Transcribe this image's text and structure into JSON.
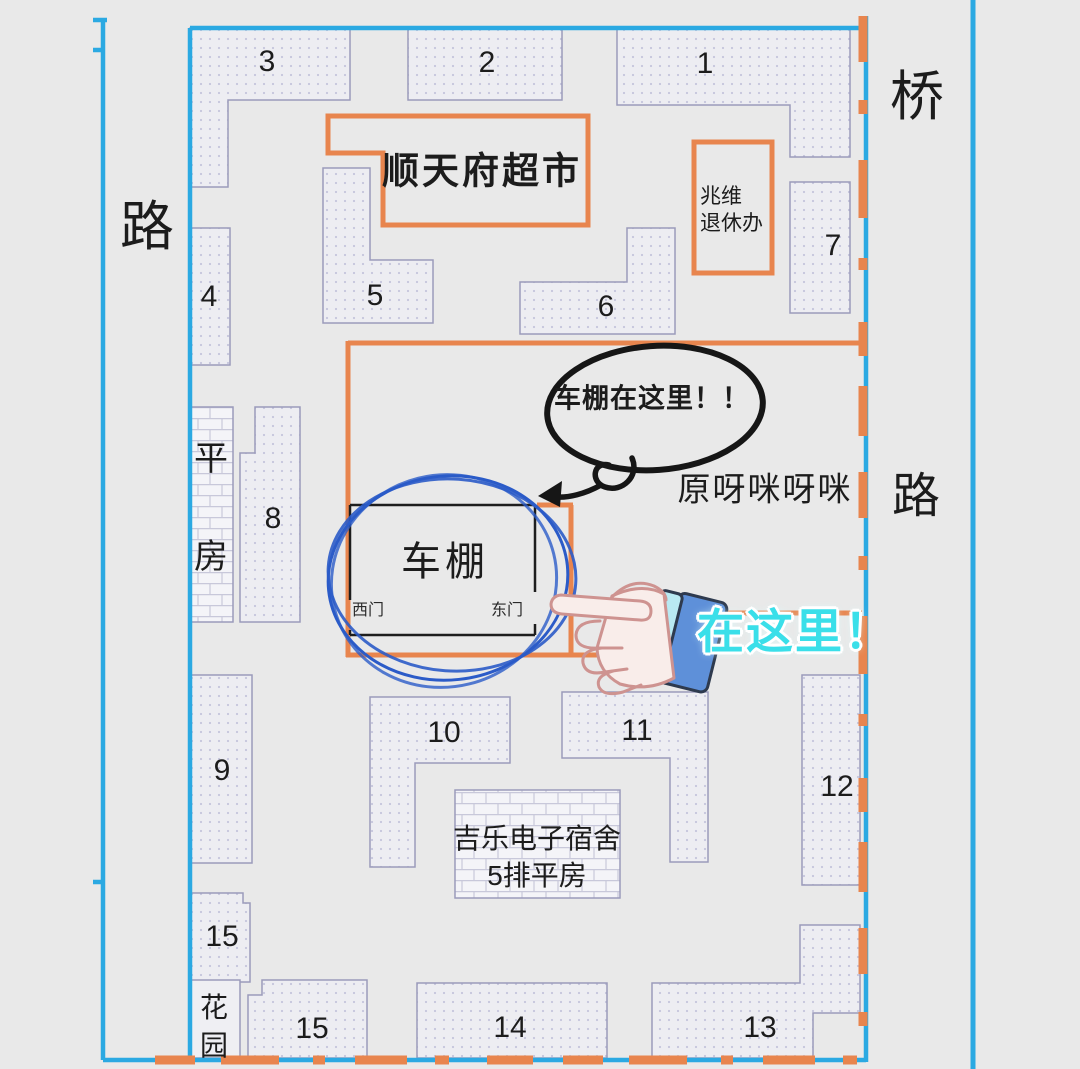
{
  "map": {
    "roads": {
      "left_road": "路",
      "right_road": "路",
      "bridge": "桥"
    },
    "buildings": {
      "b1": "1",
      "b2": "2",
      "b3": "3",
      "b4": "4",
      "b5": "5",
      "b6": "6",
      "b7": "7",
      "b8": "8",
      "b9": "9",
      "b10": "10",
      "b11": "11",
      "b12": "12",
      "b13": "13",
      "b14": "14",
      "b15_upper": "15",
      "b15_lower": "15"
    },
    "places": {
      "supermarket": "顺天府超市",
      "retirement_office_line1": "兆维",
      "retirement_office_line2": "退休办",
      "flat_house_char1": "平",
      "flat_house_char2": "房",
      "garden_char1": "花",
      "garden_char2": "园",
      "dorm_line1": "吉乐电子宿舍",
      "dorm_line2": "5排平房",
      "former_site_name": "原呀咪呀咪",
      "bike_shed": "车棚",
      "west_gate": "西门",
      "east_gate": "东门"
    },
    "annotations": {
      "speech_bubble": "车棚在这里！！",
      "here_callout": "在这里！"
    },
    "colors": {
      "road_blue": "#2BA9E2",
      "boundary_orange": "#E8854E",
      "circle_blue": "#2B5BC8",
      "callout_cyan": "#3ADFE9",
      "building_border": "#9B9BBB",
      "background": "#E9E9E9"
    }
  }
}
